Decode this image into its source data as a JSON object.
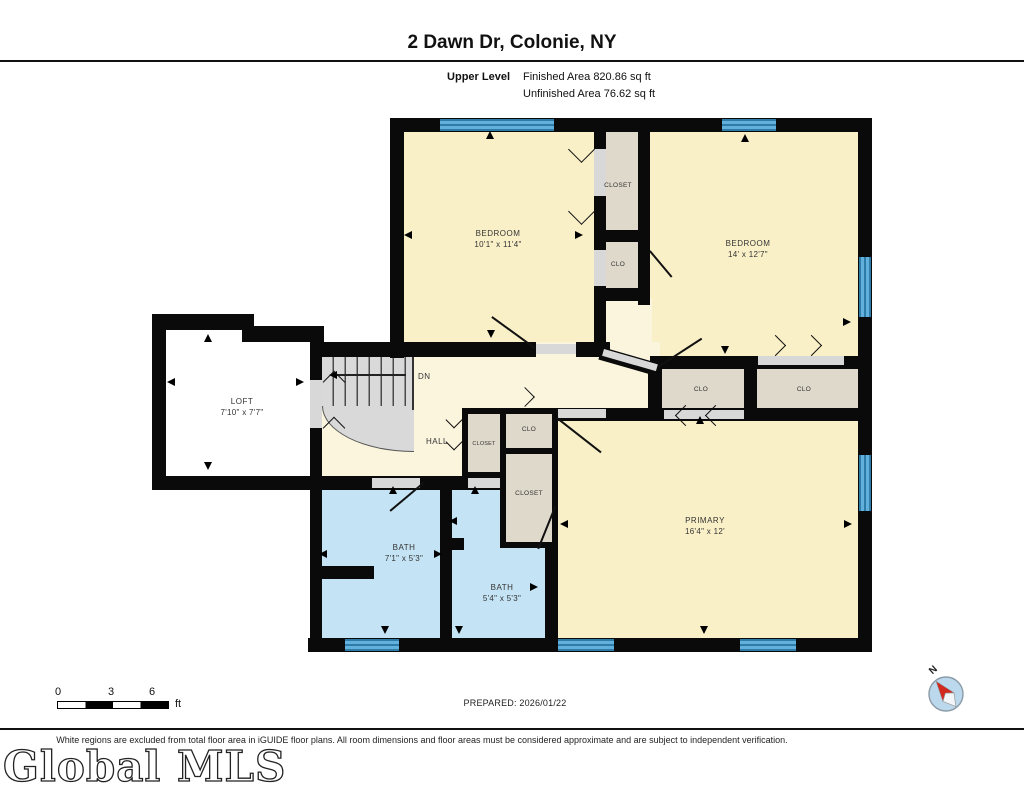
{
  "header": {
    "title": "2 Dawn Dr, Colonie, NY",
    "level_label": "Upper Level",
    "finished_area": "Finished Area 820.86 sq ft",
    "unfinished_area": "Unfinished Area 76.62 sq ft"
  },
  "rooms": {
    "bedroom1": {
      "name": "BEDROOM",
      "dims": "10'1\" x 11'4\""
    },
    "bedroom2": {
      "name": "BEDROOM",
      "dims": "14' x 12'7\""
    },
    "primary": {
      "name": "PRIMARY",
      "dims": "16'4\" x 12'"
    },
    "loft": {
      "name": "LOFT",
      "dims": "7'10\" x 7'7\""
    },
    "bath1": {
      "name": "BATH",
      "dims": "7'1\" x 5'3\""
    },
    "bath2": {
      "name": "BATH",
      "dims": "5'4\" x 5'3\""
    },
    "hall": {
      "name": "HALL"
    },
    "closet_top": {
      "name": "CLOSET"
    },
    "clo_top": {
      "name": "CLO"
    },
    "clo_left": {
      "name": "CLO"
    },
    "clo_right": {
      "name": "CLO"
    },
    "closet_small": {
      "name": "CLOSET"
    },
    "clo_small": {
      "name": "CLO"
    },
    "closet_mid": {
      "name": "CLOSET"
    },
    "stairs": {
      "label": "DN"
    }
  },
  "footer": {
    "scale": {
      "tick0": "0",
      "tick1": "3",
      "tick2": "6",
      "unit": "ft"
    },
    "prepared": "PREPARED: 2026/01/22",
    "compass_label": "N",
    "disclaimer": "White regions are excluded from total floor area in iGUIDE floor plans. All room dimensions and floor areas must be considered approximate and are subject to independent verification.",
    "logo": "Global MLS"
  },
  "colors": {
    "room_fill": "#FAF0C8",
    "hall_fill": "#FBF5DE",
    "bath_fill": "#C4E3F4",
    "closet_fill": "#DFD9CB",
    "stairs_fill": "#D9D9D9",
    "window_blue": "#63B0DD",
    "wall": "#0A0A0A",
    "compass_red": "#D2281E"
  }
}
